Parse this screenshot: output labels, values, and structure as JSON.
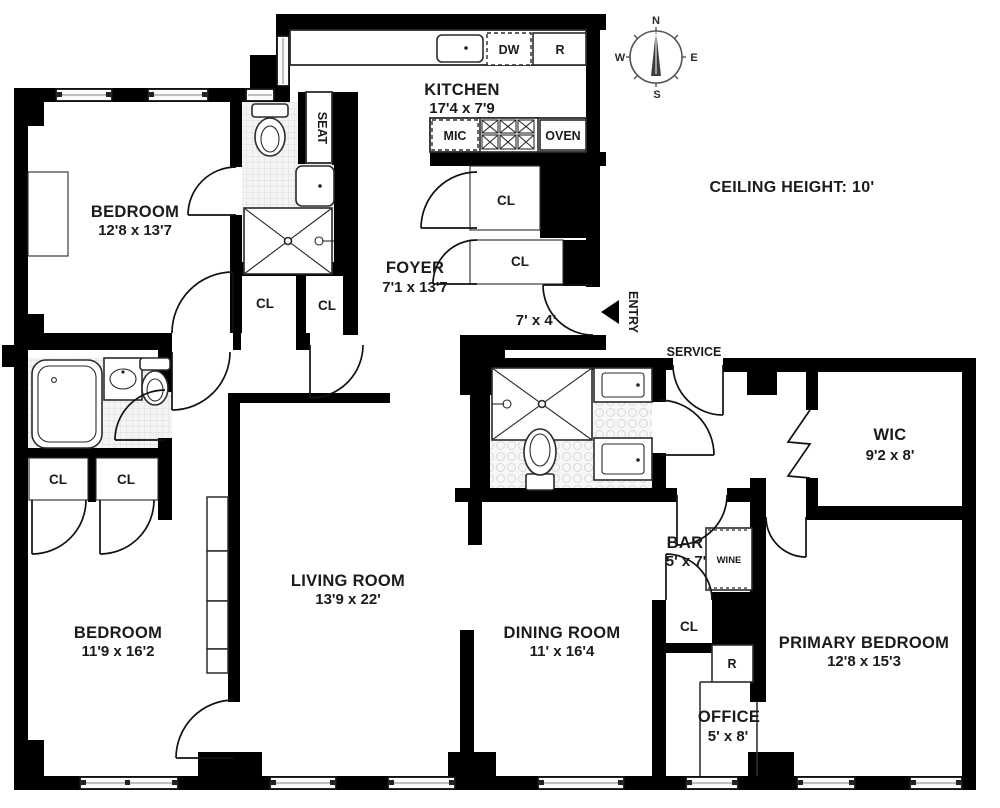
{
  "note": {
    "ceiling": "CEILING HEIGHT: 10'"
  },
  "compass": {
    "n": "N",
    "e": "E",
    "s": "S",
    "w": "W"
  },
  "rooms": {
    "kitchen": {
      "name": "KITCHEN",
      "dims": "17'4 x 7'9"
    },
    "bedroom_top": {
      "name": "BEDROOM",
      "dims": "12'8 x 13'7"
    },
    "foyer": {
      "name": "FOYER",
      "dims": "7'1 x 13'7"
    },
    "entry_hall": {
      "dims": "7' x 4'"
    },
    "living_room": {
      "name": "LIVING ROOM",
      "dims": "13'9 x 22'"
    },
    "bedroom_left": {
      "name": "BEDROOM",
      "dims": "11'9 x 16'2"
    },
    "dining_room": {
      "name": "DINING ROOM",
      "dims": "11' x 16'4"
    },
    "primary_bedroom": {
      "name": "PRIMARY BEDROOM",
      "dims": "12'8 x 15'3"
    },
    "wic": {
      "name": "WIC",
      "dims": "9'2 x 8'"
    },
    "bar": {
      "name": "BAR",
      "dims": "5' x 7'"
    },
    "office": {
      "name": "OFFICE",
      "dims": "5' x 8'"
    }
  },
  "labels": {
    "closet": "CL",
    "entry": "ENTRY",
    "service": "SERVICE",
    "seat": "SEAT",
    "wine": "WINE",
    "dishwasher": "DW",
    "refrigerator": "R",
    "microwave": "MIC",
    "oven": "OVEN",
    "r_small": "R"
  },
  "colors": {
    "wall": "#000000",
    "paper": "#ffffff",
    "tile": "#f4f4f4"
  }
}
